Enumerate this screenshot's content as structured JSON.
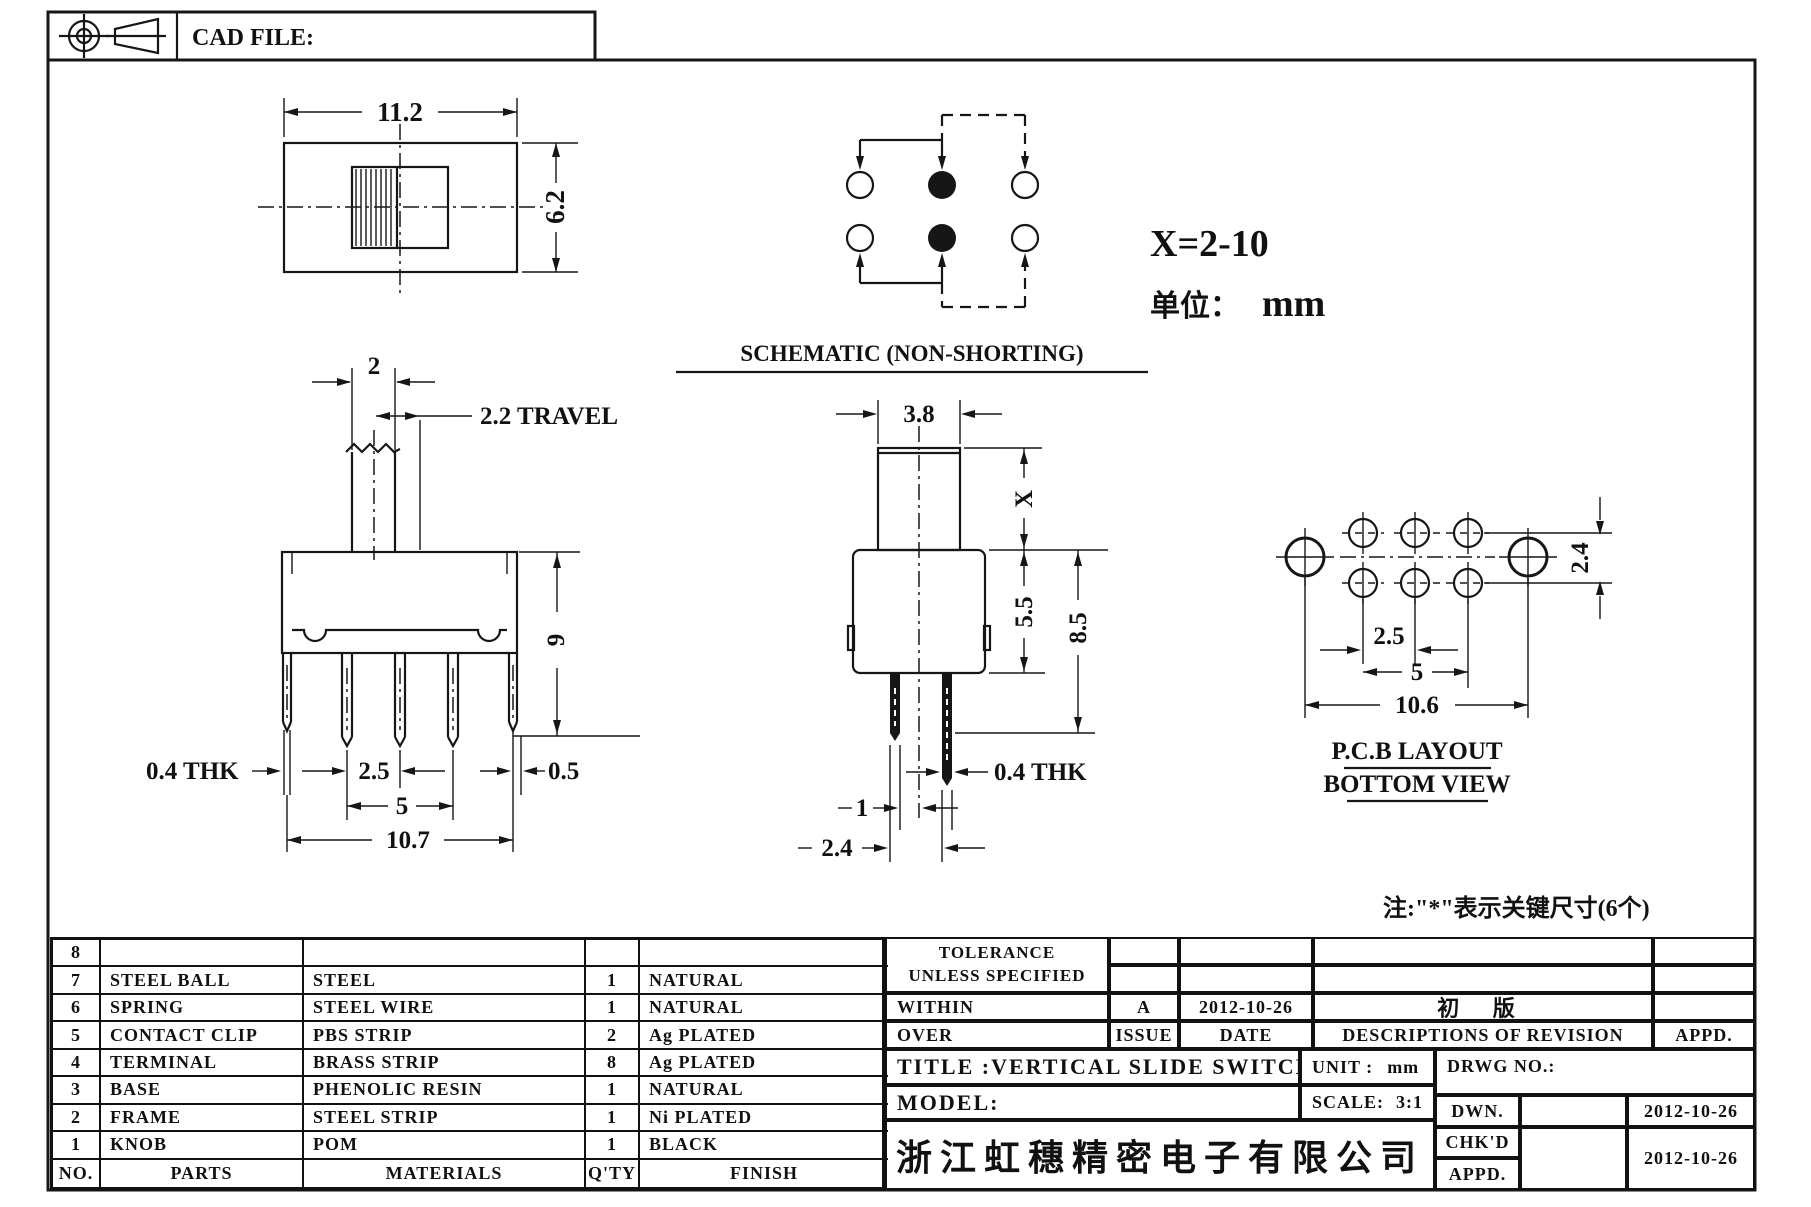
{
  "sheet": {
    "cad_file_label": "CAD FILE:"
  },
  "notes": {
    "x_range": "X=2-10",
    "unit_label": "单位：",
    "unit_value": "mm",
    "key_note": "注:\"*\"表示关键尺寸(6个)"
  },
  "views": {
    "top_view": {
      "width": "11.2",
      "height": "6.2"
    },
    "schematic": {
      "title": "SCHEMATIC (NON-SHORTING)"
    },
    "front_view": {
      "knob_width": "2",
      "travel": "2.2 TRAVEL",
      "height": "9",
      "thickness": "0.4 THK",
      "pin_pitch": "2.5",
      "pitch_span": "5",
      "body_width": "10.7",
      "offset": "0.5"
    },
    "side_view": {
      "knob_width": "3.8",
      "knob_height": "X",
      "body_height": "5.5",
      "total_height": "8.5",
      "thickness": "0.4 THK",
      "pin_gap": "1",
      "row_pitch": "2.4"
    },
    "pcb_layout": {
      "row_pitch": "2.4",
      "pin_pitch": "2.5",
      "pitch_span": "5",
      "mount_span": "10.6",
      "title_line1": "P.C.B LAYOUT",
      "title_line2": "BOTTOM VIEW"
    }
  },
  "parts_table": {
    "headers": {
      "no": "NO.",
      "parts": "PARTS",
      "materials": "MATERIALS",
      "qty": "Q'TY",
      "finish": "FINISH"
    },
    "rows": [
      {
        "no": "8",
        "part": "",
        "material": "",
        "qty": "",
        "finish": ""
      },
      {
        "no": "7",
        "part": "STEEL BALL",
        "material": "STEEL",
        "qty": "1",
        "finish": "NATURAL"
      },
      {
        "no": "6",
        "part": "SPRING",
        "material": "STEEL WIRE",
        "qty": "1",
        "finish": "NATURAL"
      },
      {
        "no": "5",
        "part": "CONTACT CLIP",
        "material": "PBS STRIP",
        "qty": "2",
        "finish": "Ag PLATED"
      },
      {
        "no": "4",
        "part": "TERMINAL",
        "material": "BRASS STRIP",
        "qty": "8",
        "finish": "Ag PLATED"
      },
      {
        "no": "3",
        "part": "BASE",
        "material": "PHENOLIC RESIN",
        "qty": "1",
        "finish": "NATURAL"
      },
      {
        "no": "2",
        "part": "FRAME",
        "material": "STEEL STRIP",
        "qty": "1",
        "finish": "Ni PLATED"
      },
      {
        "no": "1",
        "part": "KNOB",
        "material": "POM",
        "qty": "1",
        "finish": "BLACK"
      }
    ]
  },
  "title_block": {
    "tolerance_line1": "TOLERANCE",
    "tolerance_line2": "UNLESS  SPECIFIED",
    "within_label": "WITHIN",
    "over_label": "OVER",
    "issue_value": "A",
    "issue_date": "2012-10-26",
    "issue_label": "ISSUE",
    "date_label": "DATE",
    "revision_desc": "初 版",
    "revision_header": "DESCRIPTIONS OF REVISION",
    "appd_header": "APPD.",
    "title_label": "TITLE :",
    "title_value": "VERTICAL SLIDE SWITCH",
    "unit_label": "UNIT :",
    "unit_value": "mm",
    "drwg_label": "DRWG NO.:",
    "model_label": "MODEL:",
    "scale_label": "SCALE:",
    "scale_value": "3:1",
    "company": "浙江虹穗精密电子有限公司",
    "dwn_label": "DWN.",
    "dwn_date": "2012-10-26",
    "chkd_label": "CHK'D",
    "appd_label": "APPD.",
    "chkd_date": "2012-10-26"
  }
}
